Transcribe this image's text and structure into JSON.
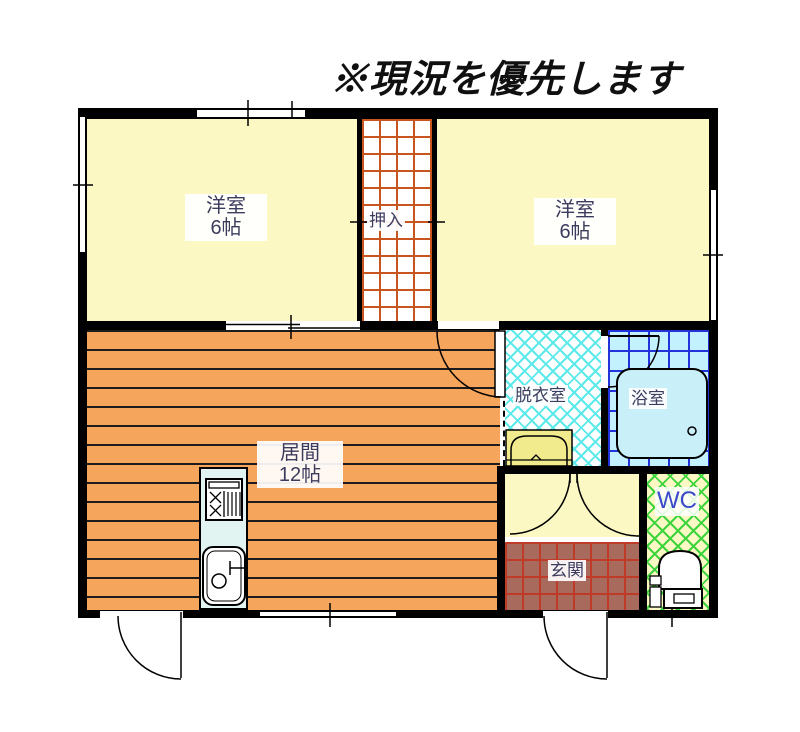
{
  "title": "※現況を優先します",
  "rooms": {
    "bedroom_left": {
      "name": "洋室",
      "size": "6帖"
    },
    "bedroom_right": {
      "name": "洋室",
      "size": "6帖"
    },
    "closet": {
      "name": "押入"
    },
    "living": {
      "name": "居間",
      "size": "12帖"
    },
    "dressing": {
      "name": "脱衣室"
    },
    "bath": {
      "name": "浴室"
    },
    "wc": {
      "name": "WC"
    },
    "entrance": {
      "name": "玄関"
    }
  },
  "colors": {
    "wall": "#000000",
    "room-yellow": "#FBF8C4",
    "living-orange": "#F6A55C",
    "living-stripe": "#1c1c1c",
    "closet-grid": "#C8541E",
    "dressing-lattice": "#5CE9E9",
    "bath-bg": "#C4F1FE",
    "bath-grid": "#2433D9",
    "tub-fill": "#C9EFF9",
    "wc-lattice": "#3ED43E",
    "genkan-bg": "#A96A5E",
    "genkan-grid": "#C03A28",
    "kitchen-fill": "#E2F4F1",
    "washer-yellow": "#F2EB8E",
    "label-ink": "#3C3C5E",
    "wc-ink": "#3A49C9"
  }
}
